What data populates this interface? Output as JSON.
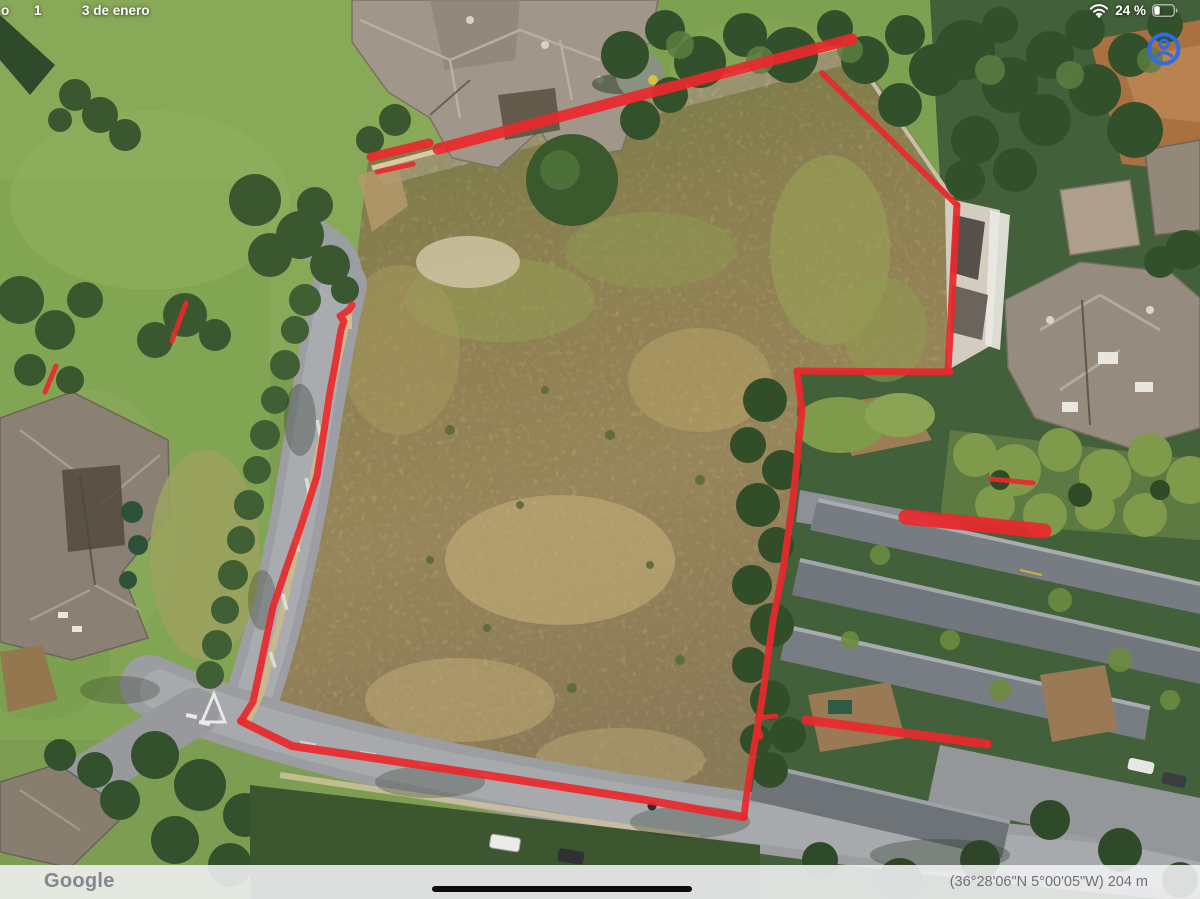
{
  "status_bar": {
    "left_fragment": "o",
    "left_day": "1",
    "left_date": "3 de enero",
    "battery_percent": "24 %"
  },
  "map": {
    "pegman_icon_color": "#2e6be5"
  },
  "footer": {
    "brand": "Google",
    "coordinates": "(36°28'06\"N 5°00'05\"W) 204 m"
  },
  "annotations": {
    "color": "#e9282d",
    "lines": [
      {
        "name": "top-boundary-short",
        "width": 9,
        "points": [
          [
            371,
            157
          ],
          [
            429,
            143
          ]
        ]
      },
      {
        "name": "top-boundary-main",
        "width": 11,
        "points": [
          [
            438,
            149
          ],
          [
            852,
            39
          ]
        ]
      },
      {
        "name": "top-boundary-thin",
        "width": 5,
        "points": [
          [
            377,
            172
          ],
          [
            413,
            164
          ]
        ]
      },
      {
        "name": "right-upper-diagonal",
        "width": 6,
        "points": [
          [
            822,
            73
          ],
          [
            957,
            205
          ]
        ]
      },
      {
        "name": "right-upper-vertical",
        "width": 7,
        "points": [
          [
            957,
            205
          ],
          [
            948,
            371
          ]
        ]
      },
      {
        "name": "mid-horizontal",
        "width": 7,
        "points": [
          [
            797,
            371
          ],
          [
            950,
            372
          ]
        ]
      },
      {
        "name": "mid-vertical",
        "width": 7,
        "points": [
          [
            797,
            371
          ],
          [
            802,
            410
          ],
          [
            793,
            500
          ],
          [
            783,
            570
          ],
          [
            773,
            620
          ],
          [
            762,
            700
          ],
          [
            752,
            760
          ],
          [
            746,
            800
          ],
          [
            744,
            817
          ]
        ]
      },
      {
        "name": "bottom-boundary",
        "width": 8,
        "points": [
          [
            744,
            817
          ],
          [
            713,
            812
          ],
          [
            646,
            800
          ],
          [
            512,
            779
          ],
          [
            380,
            759
          ],
          [
            292,
            746
          ],
          [
            257,
            729
          ],
          [
            241,
            721
          ]
        ]
      },
      {
        "name": "left-boundary",
        "width": 7,
        "points": [
          [
            241,
            721
          ],
          [
            253,
            702
          ],
          [
            273,
            607
          ],
          [
            287,
            566
          ],
          [
            300,
            529
          ],
          [
            317,
            476
          ],
          [
            330,
            392
          ],
          [
            336,
            360
          ],
          [
            341,
            330
          ],
          [
            344,
            321
          ],
          [
            340,
            316
          ],
          [
            349,
            310
          ],
          [
            352,
            305
          ]
        ]
      },
      {
        "name": "right-stub",
        "width": 5,
        "points": [
          [
            757,
            718
          ],
          [
            776,
            716
          ]
        ]
      },
      {
        "name": "lower-right-line",
        "width": 9,
        "points": [
          [
            806,
            720
          ],
          [
            987,
            744
          ]
        ]
      },
      {
        "name": "right-dash-small",
        "width": 5,
        "points": [
          [
            991,
            479
          ],
          [
            1033,
            483
          ]
        ]
      },
      {
        "name": "right-thick-mark",
        "width": 15,
        "points": [
          [
            906,
            517
          ],
          [
            1044,
            531
          ]
        ]
      },
      {
        "name": "left-dash-upper",
        "width": 5,
        "points": [
          [
            186,
            303
          ],
          [
            172,
            341
          ]
        ]
      },
      {
        "name": "left-dash-lower",
        "width": 5,
        "points": [
          [
            56,
            366
          ],
          [
            45,
            392
          ]
        ]
      },
      {
        "name": "red-dot",
        "width": 7,
        "points": [
          [
            758,
            731
          ],
          [
            760,
            736
          ]
        ]
      }
    ]
  }
}
